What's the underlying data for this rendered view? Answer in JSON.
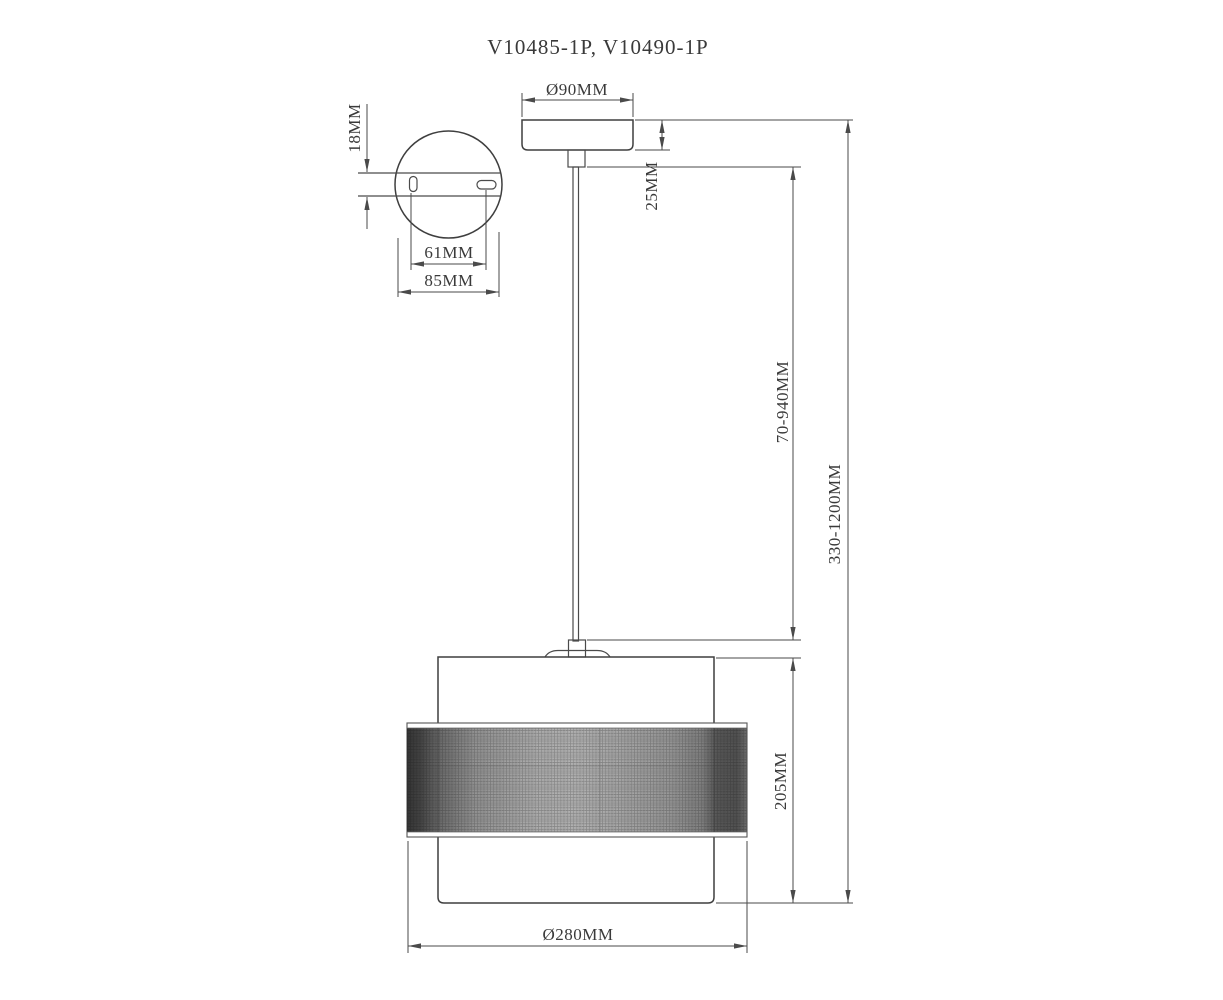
{
  "title": "V10485-1P, V10490-1P",
  "dimensions": {
    "slot_offset": "18MM",
    "hole_spacing": "61MM",
    "plate_width": "85MM",
    "canopy_diameter": "Ø90MM",
    "canopy_height": "25MM",
    "cord_length": "70-940MM",
    "overall_height": "330-1200MM",
    "shade_height": "205MM",
    "shade_diameter": "Ø280MM"
  },
  "colors": {
    "background": "#ffffff",
    "line": "#4a4a4a",
    "text": "#3a3a3a"
  }
}
